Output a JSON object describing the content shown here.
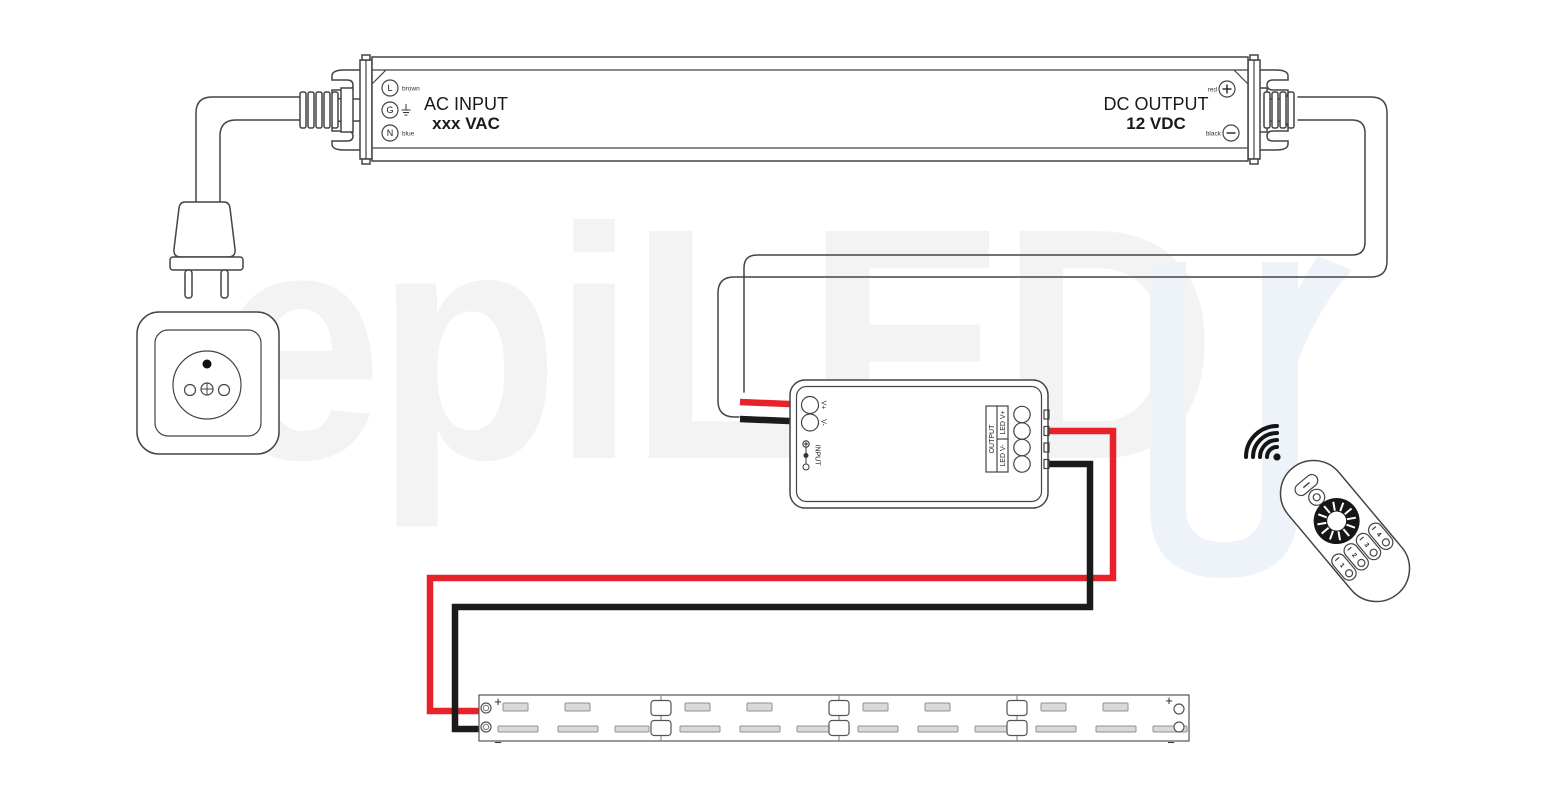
{
  "watermark": {
    "text": "epiLED"
  },
  "power_supply": {
    "ac_label": "AC INPUT",
    "ac_value": "xxx VAC",
    "dc_label": "DC OUTPUT",
    "dc_value": "12 VDC",
    "terminals": {
      "live": "L",
      "live_wire": "brown",
      "ground": "G",
      "neutral": "N",
      "neutral_wire": "blue",
      "dc_plus_wire": "red",
      "dc_minus_wire": "black",
      "plus": "+",
      "minus": "−"
    }
  },
  "controller": {
    "v_plus": "V+",
    "v_minus": "V-",
    "input_label": "INPUT",
    "output_label": "OUTPUT",
    "led_v_plus": "LED V+",
    "led_v_minus": "LED V-"
  },
  "led_strip": {
    "plus": "+",
    "minus": "−"
  },
  "remote": {
    "zones": [
      "1",
      "2",
      "3",
      "4"
    ]
  },
  "colors": {
    "wire_red": "#e8222b",
    "wire_black": "#1b1b1b",
    "outline": "#444444",
    "watermark_gray": "#f3f3f3",
    "watermark_blue": "#eef3fa",
    "pad_fill": "#d9d9d9"
  }
}
